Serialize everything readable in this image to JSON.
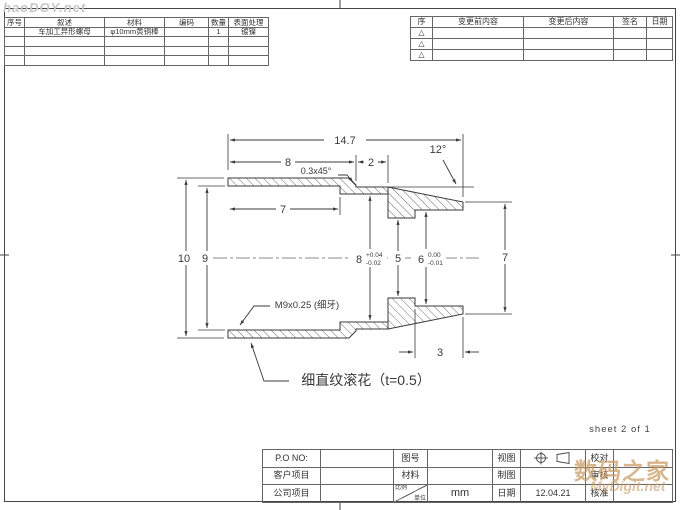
{
  "colors": {
    "line": "#3a3a3a",
    "text": "#333333",
    "border": "#444444",
    "watermark_tan": "#c79a62",
    "watermark_gray": "#c6c6c6"
  },
  "watermarks": {
    "top_left": "haoDOY.net",
    "brand_cn": "数码之家",
    "brand_en": "MyDigit.net"
  },
  "sheet": {
    "note": "sheet 2 of 1"
  },
  "bom": {
    "headers": [
      "序号",
      "叙述",
      "材料",
      "编码",
      "数量",
      "表面处理"
    ],
    "row1": {
      "desc": "车加工异形螺母",
      "material": "φ10mm黄铜棒",
      "qty": "1",
      "finish": "镀镍"
    }
  },
  "revisions": {
    "headers": [
      "序",
      "变更前内容",
      "变更后内容",
      "签名",
      "日期"
    ],
    "marker": "△"
  },
  "title_block": {
    "po_label": "P.O  NO:",
    "customer_label": "客户项目",
    "company_label": "公司项目",
    "drawing_no_label": "图号",
    "material_label": "材料",
    "scale_label": "比例",
    "unit_label": "单位",
    "unit_value": "mm",
    "view_label": "视图",
    "draft_label": "制图",
    "date_label": "日期",
    "date_value": "12.04.21",
    "proof_label": "校对",
    "review_label": "审核",
    "approve_label": "核准"
  },
  "drawing": {
    "dims": {
      "overall": "14.7",
      "knurl_len": "8",
      "mid_len": "2",
      "taper_angle": "12°",
      "chamfer": "0.3x45°",
      "thread_depth": "7",
      "od": "10",
      "thread_d": "9",
      "bore8": "8",
      "bore8_tol_up": "+0.04",
      "bore8_tol_dn": "-0.02",
      "bore5": "5",
      "bore6": "6",
      "bore6_tol_up": "0.00",
      "bore6_tol_dn": "-0.01",
      "tip_od": "7",
      "tip_len": "3",
      "thread_note": "M9x0.25 (细牙)",
      "knurl_note": "细直纹滚花（t=0.5）"
    }
  }
}
